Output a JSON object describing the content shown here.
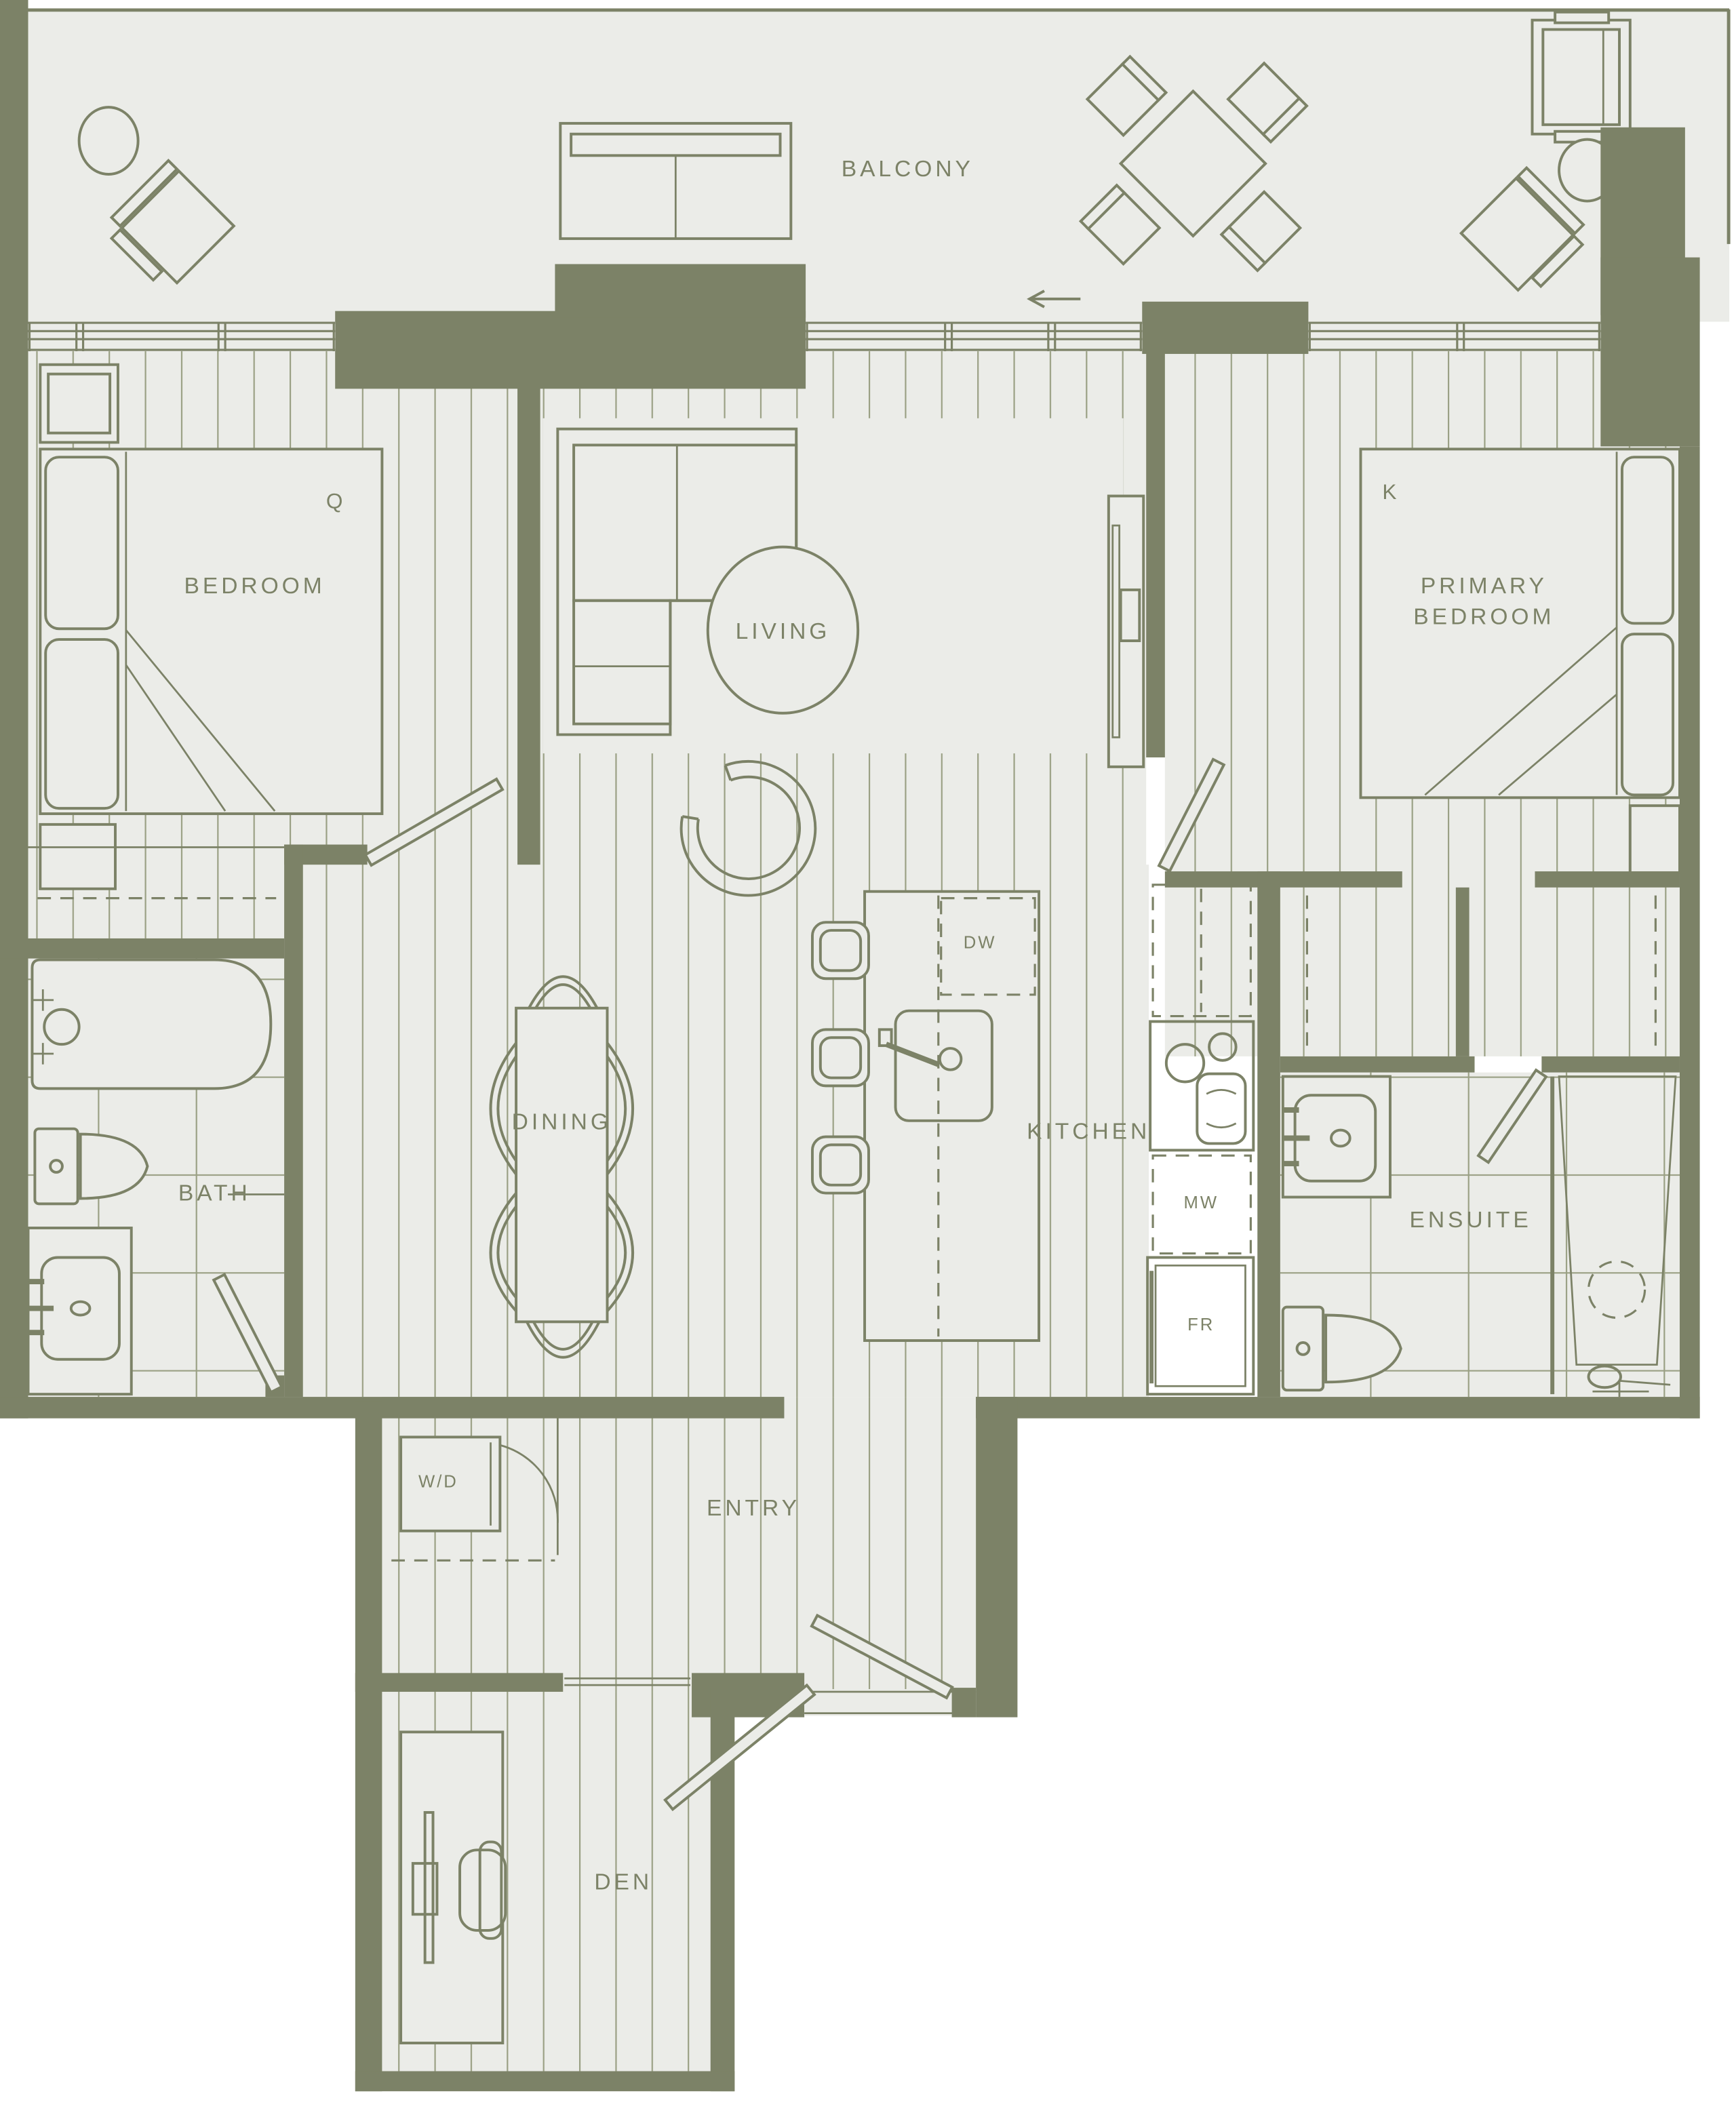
{
  "plan": {
    "type": "apartment-floor-plan",
    "rooms": [
      "BALCONY",
      "BEDROOM",
      "LIVING",
      "PRIMARY BEDROOM",
      "DINING",
      "KITCHEN",
      "BATH",
      "ENSUITE",
      "ENTRY",
      "DEN"
    ],
    "labels": {
      "balcony": "BALCONY",
      "bedroom": "BEDROOM",
      "bedroom_size": "Q",
      "living": "LIVING",
      "primary_line1": "PRIMARY",
      "primary_line2": "BEDROOM",
      "primary_size": "K",
      "dining": "DINING",
      "kitchen": "KITCHEN",
      "bath": "BATH",
      "ensuite": "ENSUITE",
      "entry": "ENTRY",
      "den": "DEN",
      "washer_dryer": "W/D",
      "dishwasher": "DW",
      "microwave": "MW",
      "fridge": "FR"
    },
    "colors": {
      "wall": "#7C8267",
      "line": "#7C8267",
      "text": "#7C8267",
      "floor": "#EBECE8",
      "plank_line": "#9AA084",
      "page": "#FFFFFF"
    }
  }
}
